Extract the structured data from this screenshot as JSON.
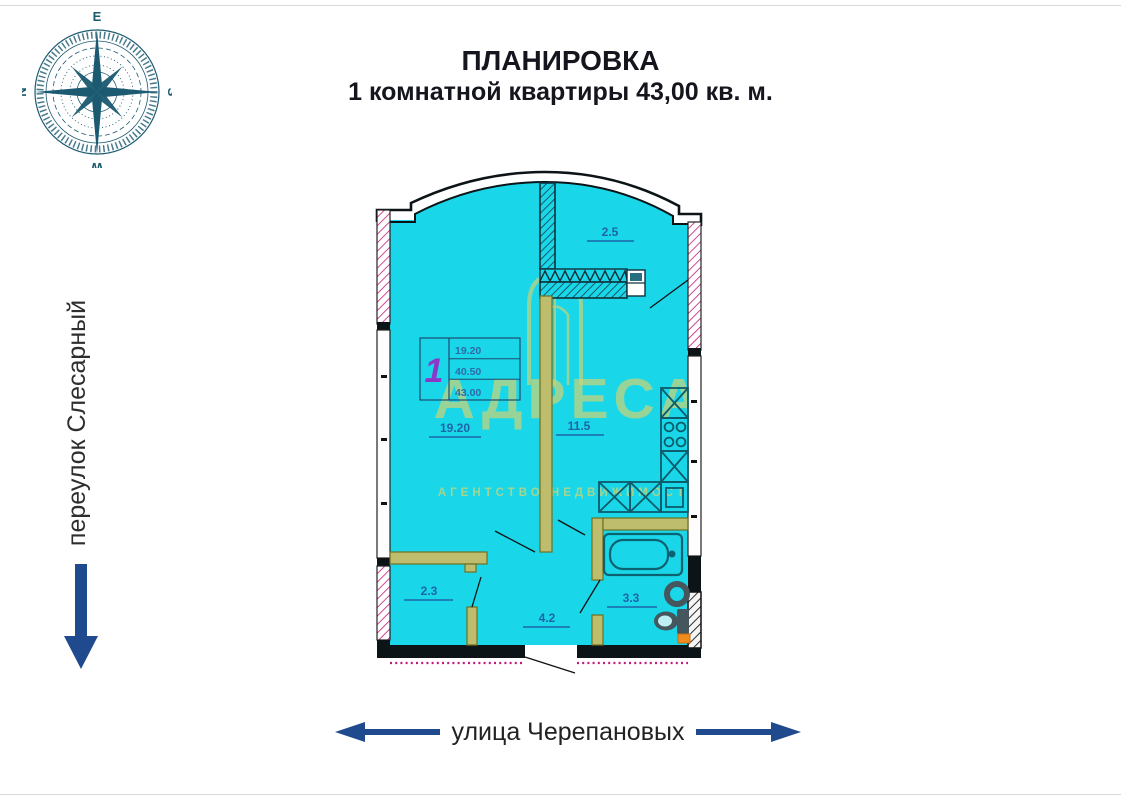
{
  "title": {
    "line1": "ПЛАНИРОВКА",
    "line2": "1 комнатной квартиры 43,00 кв. м."
  },
  "compass": {
    "top": "E",
    "right": "S",
    "bottom": "W",
    "left": "N"
  },
  "streets": {
    "left": "переулок Слесарный",
    "bottom": "улица Черепановых"
  },
  "plan": {
    "rooms": [
      {
        "id": "living-room",
        "area": "19.20"
      },
      {
        "id": "kitchen",
        "area": "11.5"
      },
      {
        "id": "balcony",
        "area": "2.5"
      },
      {
        "id": "closet",
        "area": "2.3"
      },
      {
        "id": "hallway",
        "area": "4.2"
      },
      {
        "id": "bathroom",
        "area": "3.3"
      }
    ],
    "stamp": {
      "rooms_count": "1",
      "living_area": "19.20",
      "area_no_balcony": "40.50",
      "total_area": "43.00"
    }
  },
  "watermark": {
    "brand": "АДРЕСА",
    "subtitle": "АГЕНТСТВО НЕДВИЖИМОСТИ"
  },
  "colors": {
    "plan_fill": "#19d7e8",
    "wall_dark": "#0c1418",
    "partition_olive": "#bdbd6d",
    "hatch_pink": "#c2187e",
    "label_blue": "#1f63a8",
    "stamp_purple": "#8d36c9",
    "accent_blue": "#1f4b8e",
    "watermark_yellow": "#c9d478",
    "orange": "#f08c1e"
  }
}
